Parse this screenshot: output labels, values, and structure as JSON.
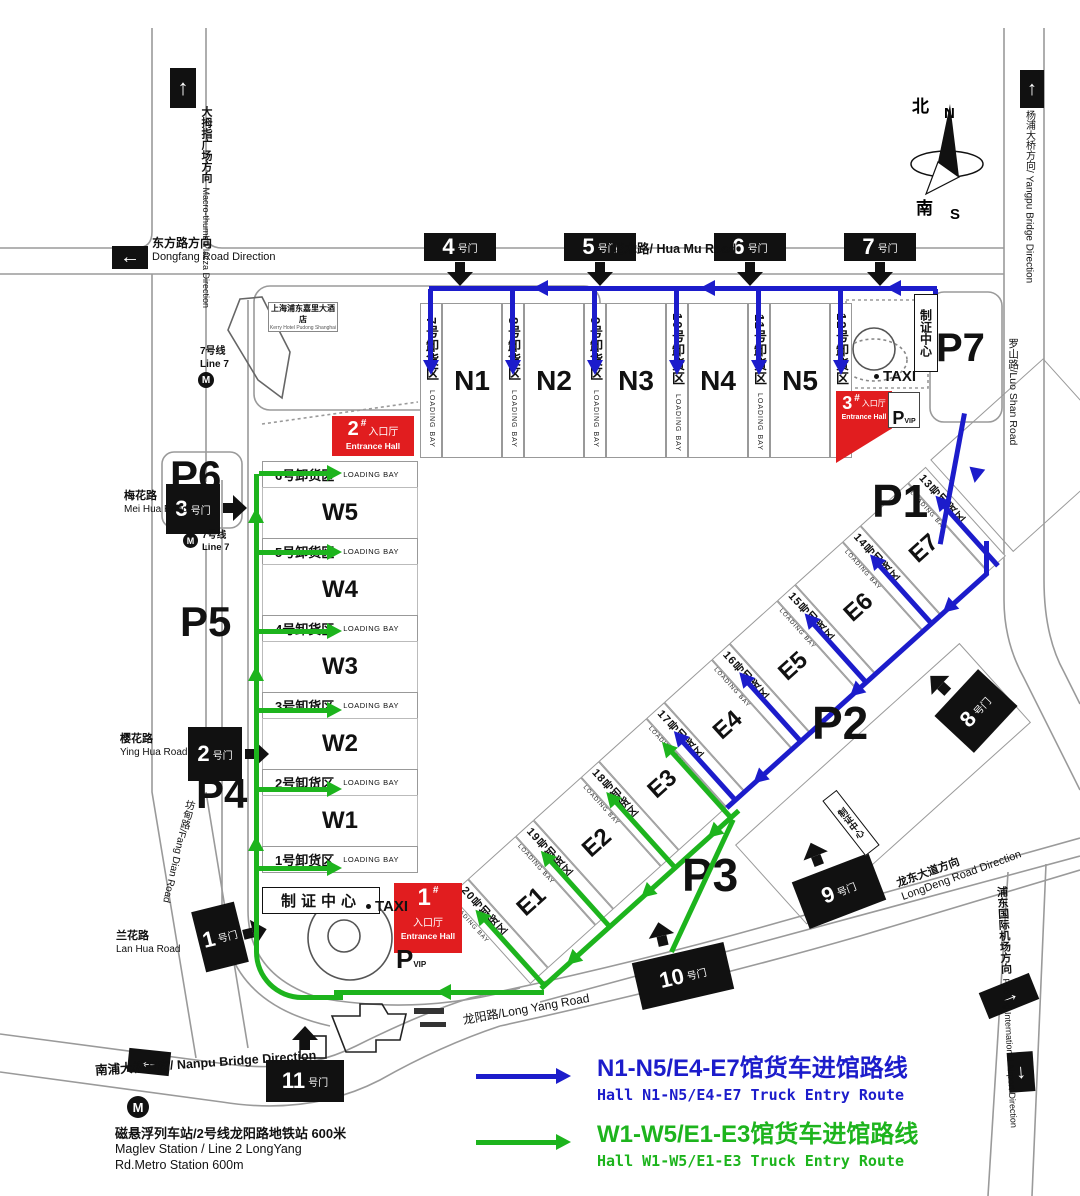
{
  "colors": {
    "route_blue": "#1c1ccb",
    "route_green": "#1db41d",
    "entrance_red": "#e11d1f",
    "gate_black": "#111111"
  },
  "compass": {
    "n_cn": "北",
    "n_en": "N",
    "s_cn": "南",
    "s_en": "S"
  },
  "halls": {
    "north": [
      "N1",
      "N2",
      "N3",
      "N4",
      "N5"
    ],
    "west": [
      "W5",
      "W4",
      "W3",
      "W2",
      "W1"
    ],
    "east": [
      "E1",
      "E2",
      "E3",
      "E4",
      "E5",
      "E6",
      "E7"
    ]
  },
  "bays": {
    "suffix": "LOADING BAY",
    "north": [
      "7号卸货区",
      "8号卸货区",
      "9号卸货区",
      "10号卸货区",
      "11号卸货区",
      "12号卸货区"
    ],
    "west": [
      "6号卸货区",
      "5号卸货区",
      "4号卸货区",
      "3号卸货区",
      "2号卸货区",
      "1号卸货区"
    ],
    "east": [
      "20号卸货区",
      "19号卸货区",
      "18号卸货区",
      "17号卸货区",
      "16号卸货区",
      "15号卸货区",
      "14号卸货区",
      "13号卸货区"
    ]
  },
  "parking": {
    "p1": "P1",
    "p2": "P2",
    "p3": "P3",
    "p4": "P4",
    "p5": "P5",
    "p6": "P6",
    "p7": "P7"
  },
  "gates": {
    "suffix": "号门",
    "g1": "1",
    "g2": "2",
    "g3": "3",
    "g4": "4",
    "g5": "5",
    "g6": "6",
    "g7": "7",
    "g8": "8",
    "g9": "9",
    "g10": "10",
    "g11": "11"
  },
  "entrance": {
    "hash": "#",
    "cn": "入口厅",
    "en": "Entrance Hall",
    "e1": "1",
    "e2": "2",
    "e3": "3"
  },
  "badge_center": "制证中心",
  "taxi": "TAXI",
  "vip": {
    "p": "P",
    "sub": "VIP"
  },
  "roads": {
    "macro_thumb": {
      "cn": "大拇指广场方向",
      "en": "Macro-thumb Plazza Direction"
    },
    "dongfang": {
      "cn": "东方路方向",
      "en": "Dongfang Road Direction"
    },
    "huamu": {
      "label": "花木路/ Hua Mu Road"
    },
    "yangpu": {
      "label": "杨浦大桥方向/ Yangpu Bridge Direction"
    },
    "luoshan": {
      "label": "罗山路/Luo Shan Road"
    },
    "meihua": {
      "cn": "梅花路",
      "en": "Mei Hua Road"
    },
    "yinghua": {
      "cn": "樱花路",
      "en": "Ying Hua Road"
    },
    "lanhua": {
      "cn": "兰花路",
      "en": "Lan Hua Road"
    },
    "fangdian": {
      "label": "坊甸路/Fang Dian Road"
    },
    "longyang": {
      "label": "龙阳路/Long Yang Road"
    },
    "longdong": {
      "cn": "龙东大道方向",
      "en": "LongDeng Road Direction"
    },
    "airport": {
      "cn": "浦东国际机场方向",
      "en": "Pudong International Airport Direction"
    },
    "nanpu": {
      "label": "南浦大桥方向/ Nanpu Bridge Direction"
    }
  },
  "metro": {
    "icon": "M",
    "line7_cn": "7号线",
    "line7_en": "Line 7",
    "maglev_cn": "磁悬浮列车站/2号线龙阳路地铁站  600米",
    "maglev_en1": "Maglev Station / Line 2 LongYang",
    "maglev_en2": "Rd.Metro Station 600m"
  },
  "hotel": {
    "cn": "上海浦东嘉里大酒店",
    "en": "Kerry Hotel Pudong Shanghai"
  },
  "legend": {
    "blue": {
      "cn": "N1-N5/E4-E7馆货车进馆路线",
      "en": "Hall N1-N5/E4-E7 Truck Entry Route"
    },
    "green": {
      "cn": "W1-W5/E1-E3馆货车进馆路线",
      "en": "Hall W1-W5/E1-E3 Truck Entry Route"
    }
  }
}
